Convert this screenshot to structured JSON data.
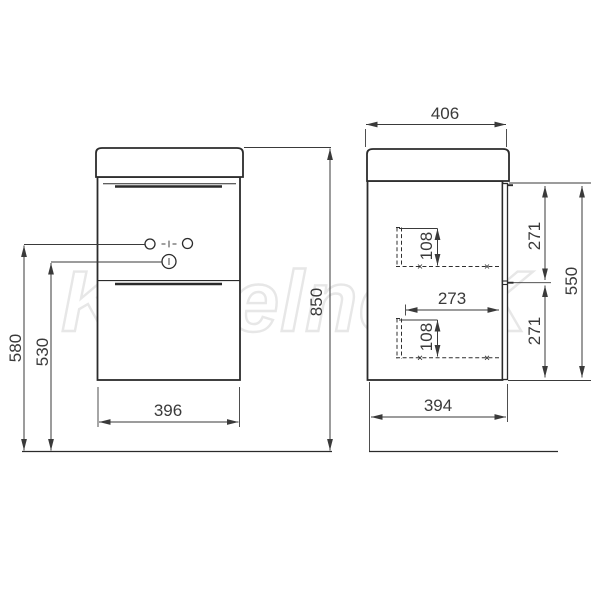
{
  "watermark": {
    "text": "KupelneSK"
  },
  "drawing": {
    "front_view": {
      "overall_height": "850",
      "faucet_height": "580",
      "drain_height": "530",
      "cabinet_width": "396"
    },
    "side_view": {
      "top_depth": "406",
      "cabinet_depth": "394",
      "body_height": "550",
      "upper_front_height": "271",
      "lower_front_height": "271",
      "upper_drawer_height": "108",
      "lower_drawer_height": "108",
      "drawer_depth": "273"
    },
    "colors": {
      "line": "#2b2b2b",
      "dimension_text": "#3a3a3a",
      "watermark": "#e7e7e7"
    }
  }
}
